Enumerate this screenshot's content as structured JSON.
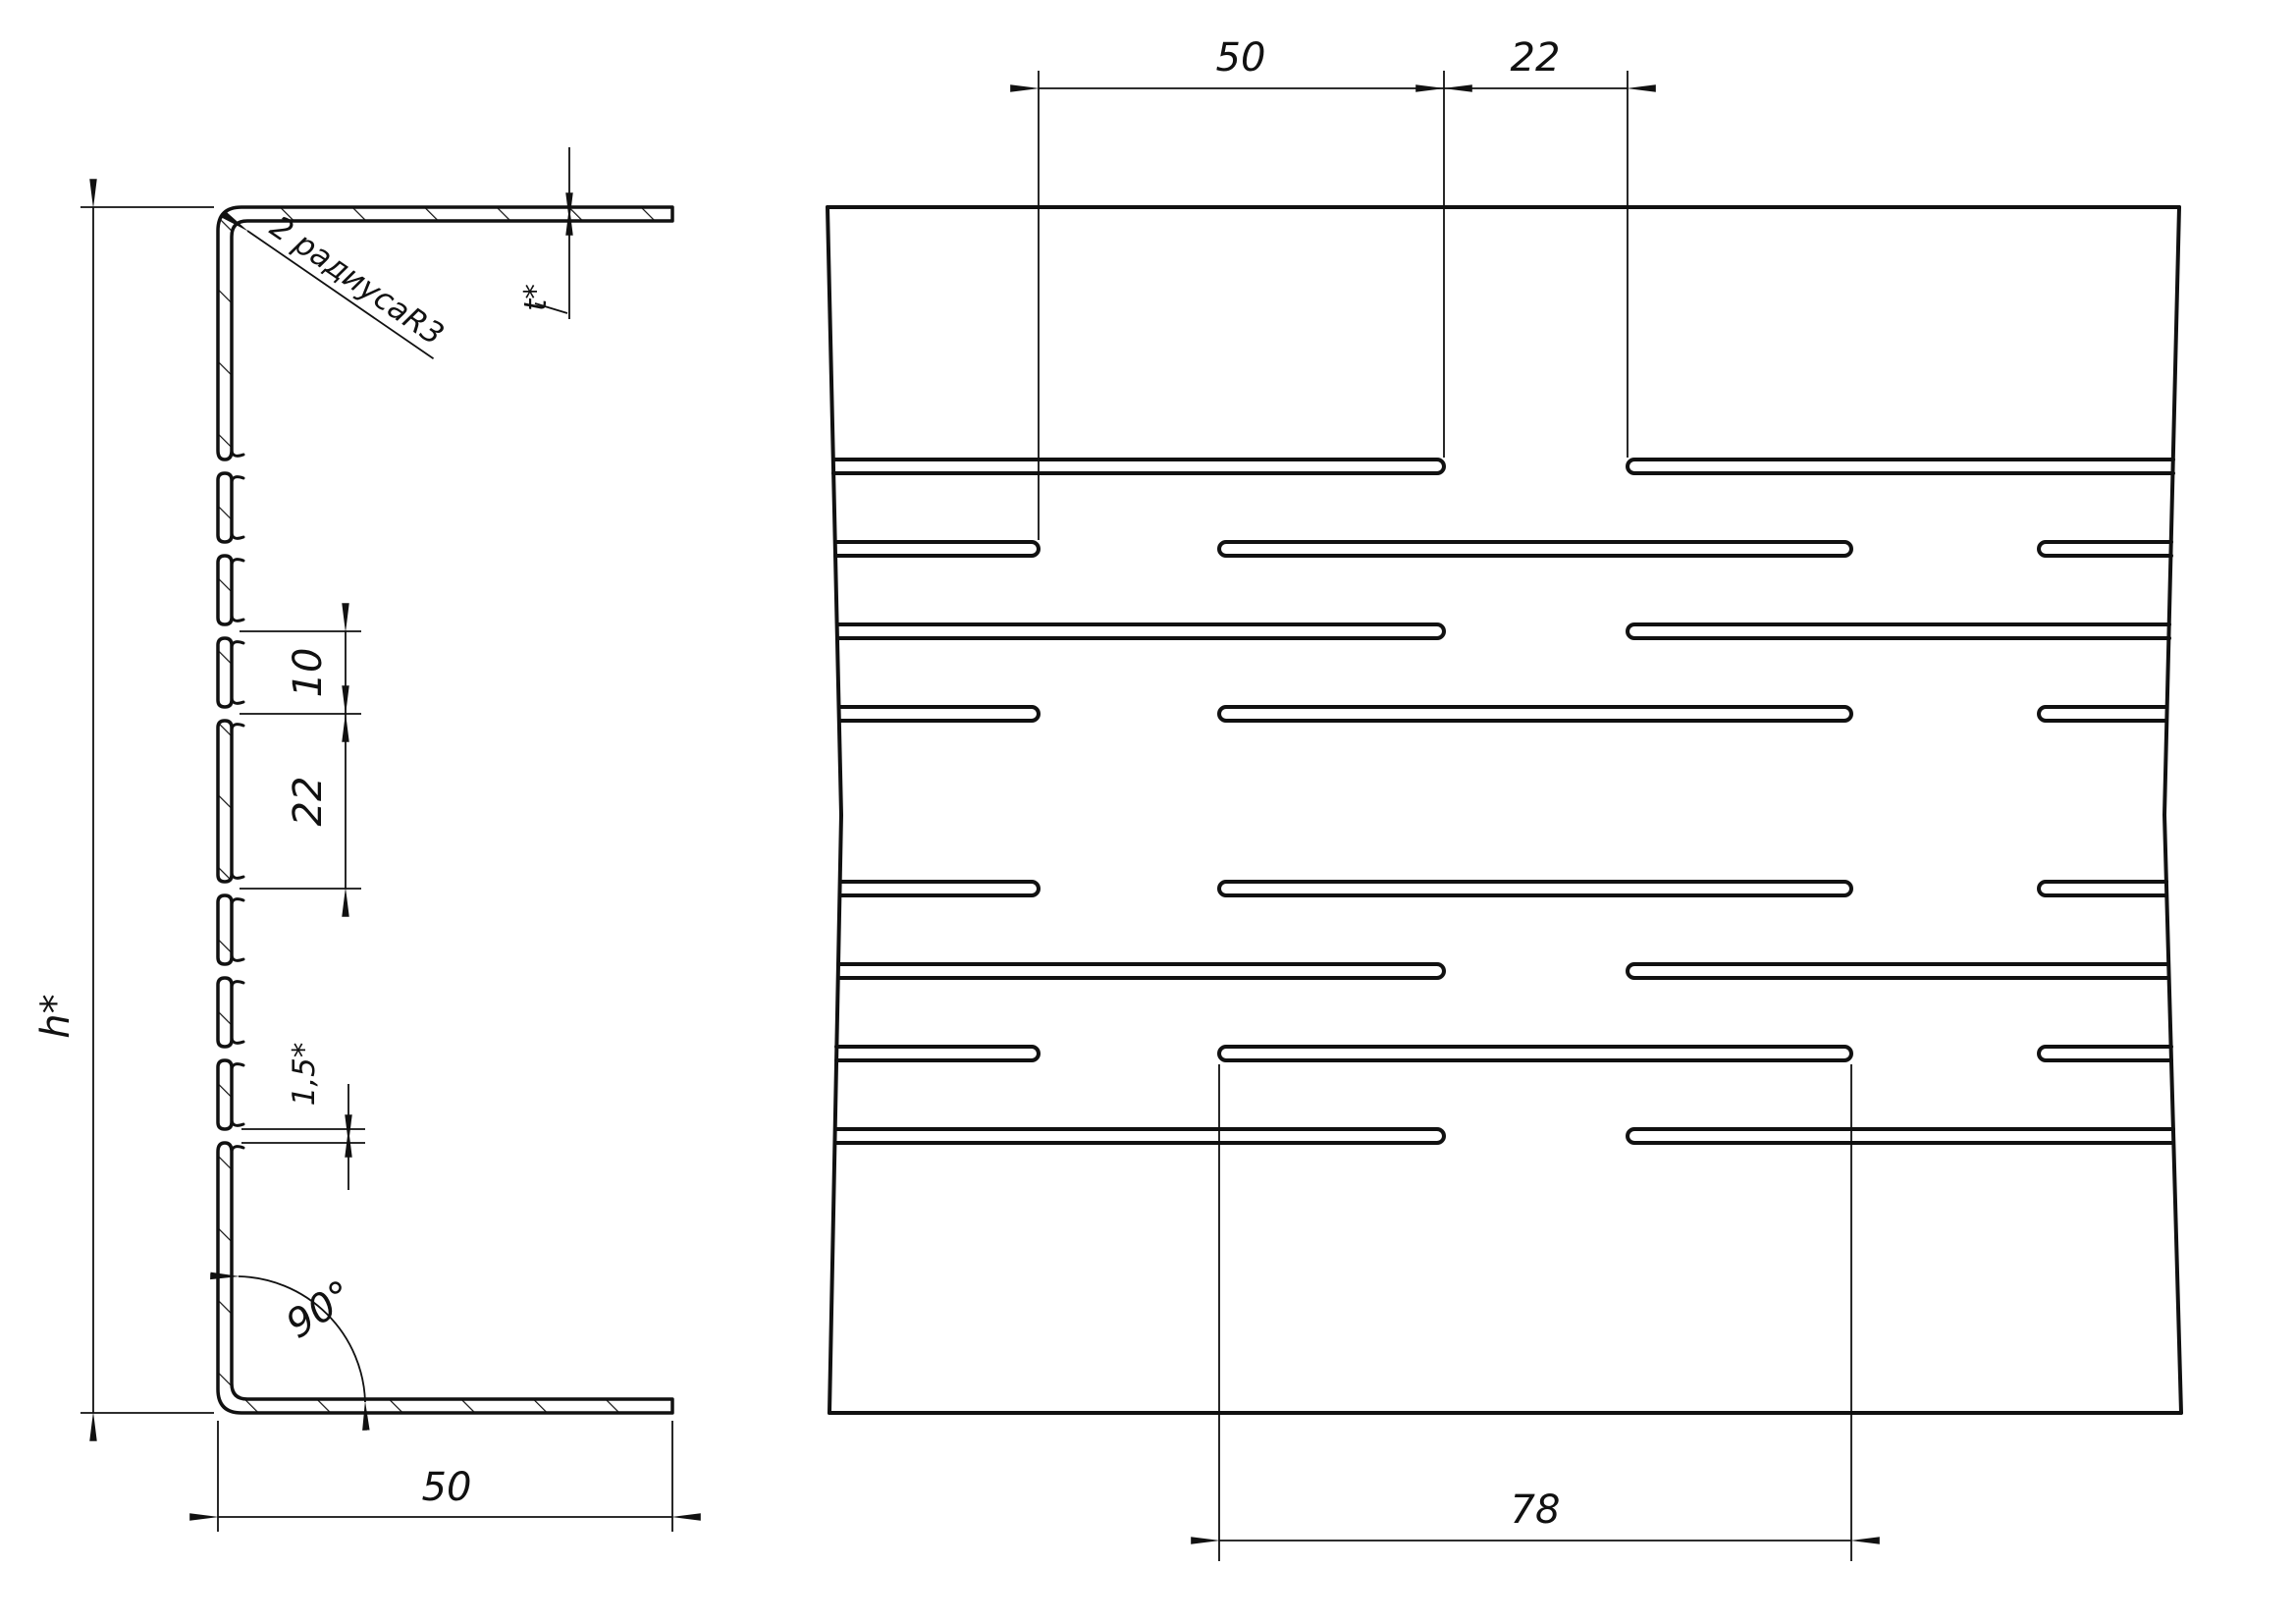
{
  "drawing": {
    "background": "#ffffff",
    "line_color": "#111111",
    "left_view": {
      "description": "profile cross-section",
      "dims": {
        "height": "h*",
        "flange_width": "50",
        "thickness": "t*",
        "corner_radius": "R3",
        "corner_radius_note": "2 радиуса",
        "bend_angle": "90°",
        "web_bridge_small": "10",
        "web_bridge_large": "22",
        "slot_gap": "1,5*"
      }
    },
    "right_view": {
      "description": "slotted web face view",
      "dims": {
        "slot_stagger": "50",
        "slot_bridge": "22",
        "slot_length": "78"
      }
    }
  }
}
